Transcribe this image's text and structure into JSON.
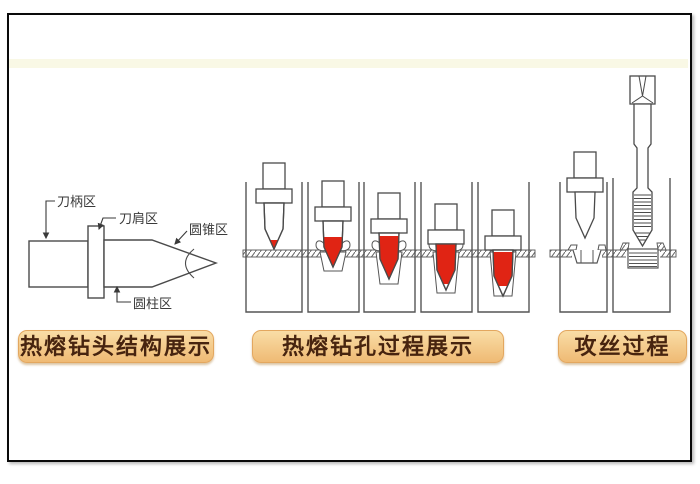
{
  "sections": {
    "structure_label": "热熔钻头结构展示",
    "process_label": "热熔钻孔过程展示",
    "tapping_label": "攻丝过程"
  },
  "structure_labels": {
    "shank": "刀柄区",
    "shoulder": "刀肩区",
    "cone": "圆锥区",
    "cylinder": "圆柱区"
  },
  "colors": {
    "hot_red": "#e02414",
    "line": "#4a4a4a",
    "badge_bg": "#f2c684",
    "badge_text": "#47240f"
  }
}
